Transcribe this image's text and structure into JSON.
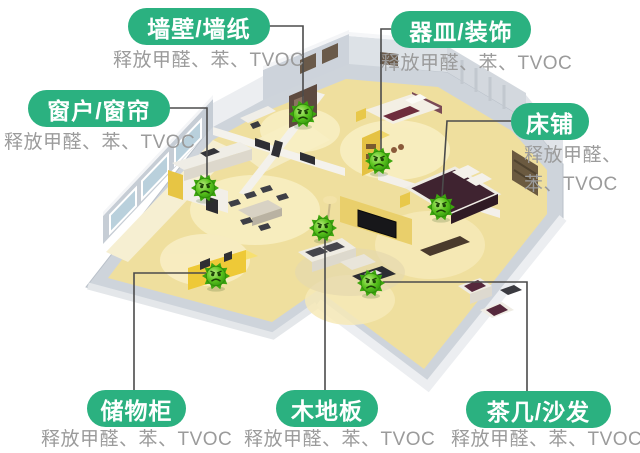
{
  "colors": {
    "background": "#ffffff",
    "pill_green": "#2bb180",
    "sublabel_gray": "#9b9b9b",
    "connector_line": "#4b4b4b",
    "germ_green": "#5dc51f",
    "floor_yellow": "#efdf9e",
    "wall_gray": "#ced4db"
  },
  "icons": {
    "germ": "green-spiky-germ-with-angry-face"
  },
  "labels": [
    {
      "id": "wall-wallpaper",
      "title": "墙壁/墙纸",
      "sub": "释放甲醛、苯、TVOC"
    },
    {
      "id": "vessel-decor",
      "title": "器皿/装饰",
      "sub": "释放甲醛、苯、TVOC"
    },
    {
      "id": "window-curtain",
      "title": "窗户/窗帘",
      "sub": "释放甲醛、苯、TVOC"
    },
    {
      "id": "bed",
      "title": "床铺",
      "sub_line1": "释放甲醛、",
      "sub_line2": "苯、TVOC"
    },
    {
      "id": "storage-cabinet",
      "title": "储物柜",
      "sub": "释放甲醛、苯、TVOC"
    },
    {
      "id": "wood-floor",
      "title": "木地板",
      "sub": "释放甲醛、苯、TVOC"
    },
    {
      "id": "tea-table-sofa",
      "title": "茶几/沙发",
      "sub": "释放甲醛、苯、TVOC"
    }
  ]
}
